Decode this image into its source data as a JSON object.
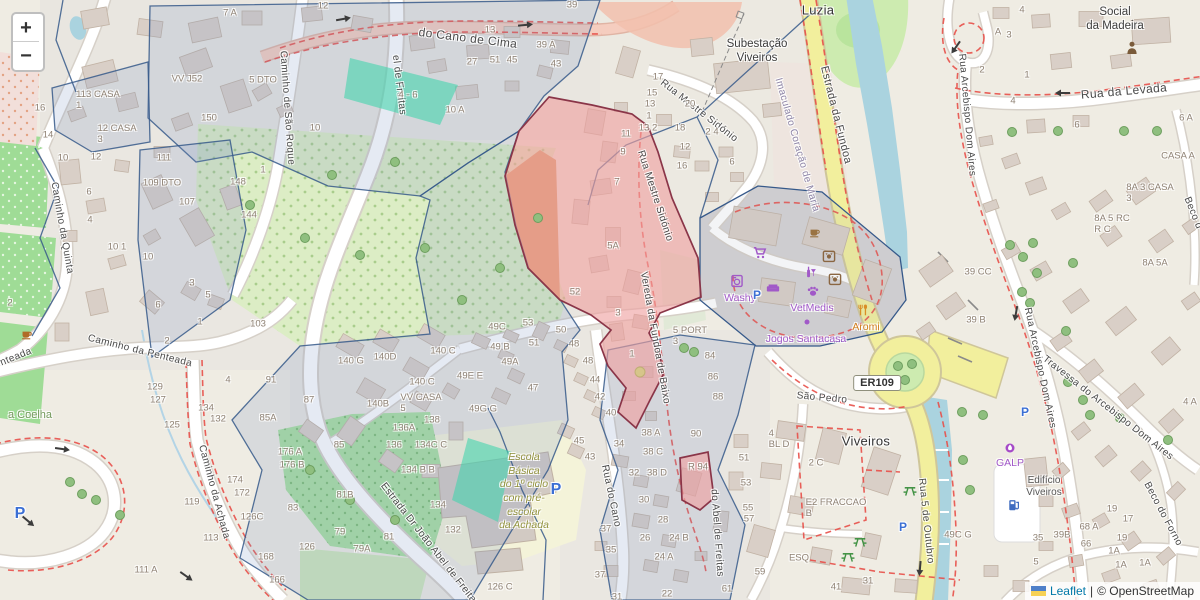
{
  "app": {
    "kind": "leaflet-openstreetmap-view"
  },
  "controls": {
    "zoom_in": "+",
    "zoom_out": "−"
  },
  "attribution": {
    "leaflet": "Leaflet",
    "sep": "|",
    "osm": "© OpenStreetMap"
  },
  "colors": {
    "water": "#aad3df",
    "road_yellow": "#f2ef9d",
    "overlay_red": "#ef9f9f",
    "overlay_red_border": "#8a3548",
    "overlay_teal": "#45d4ad",
    "admin_tint": "#7c98c3",
    "admin_border": "#36598a",
    "poi_purple": "#a159c8",
    "poi_orange": "#d98e26",
    "poi_brown": "#8a6642",
    "route_red": "#e8504a",
    "green": "#cdebb0",
    "building": "#d9cfc7",
    "leaflet_link": "#0078a8"
  },
  "labels": [
    {
      "t": "el de Freitas",
      "x": 399,
      "y": 85,
      "r": 83,
      "c": "s",
      "n": "street-label-abel-de-freitas-n"
    },
    {
      "t": "Caminho de São Roque",
      "x": 287,
      "y": 108,
      "r": 86,
      "c": "s"
    },
    {
      "t": "do Cano de Cima",
      "x": 468,
      "y": 38,
      "r": 7,
      "c": "s",
      "fs": 12
    },
    {
      "t": "Caminho da Quinta",
      "x": 62,
      "y": 228,
      "r": 80,
      "c": "s"
    },
    {
      "t": "nteada",
      "x": 16,
      "y": 357,
      "r": -22,
      "c": "s"
    },
    {
      "t": "Caminho da Penteada",
      "x": 140,
      "y": 351,
      "r": 14,
      "c": "s"
    },
    {
      "t": "Caminho da Achada",
      "x": 214,
      "y": 492,
      "r": 75,
      "c": "s"
    },
    {
      "t": "Estrada Dr João Abel de Freitas",
      "x": 430,
      "y": 545,
      "r": 52,
      "c": "s"
    },
    {
      "t": "do Abel de Freitas",
      "x": 717,
      "y": 533,
      "r": 86,
      "c": "s"
    },
    {
      "t": "Rua do Cano",
      "x": 611,
      "y": 496,
      "r": 78,
      "c": "s"
    },
    {
      "t": "Rua Mestre Sidónio",
      "x": 699,
      "y": 111,
      "r": 38,
      "c": "s"
    },
    {
      "t": "Rua Mestre Sidónio",
      "x": 655,
      "y": 196,
      "r": 72,
      "c": "s"
    },
    {
      "t": "Vereda da Fundoa de Baixo",
      "x": 655,
      "y": 338,
      "r": 80,
      "c": "s"
    },
    {
      "t": "Estrada da Fundoa",
      "x": 836,
      "y": 115,
      "r": 76,
      "c": "s",
      "fs": 11
    },
    {
      "t": "Imaculado Coração de Maria",
      "x": 797,
      "y": 145,
      "r": 74,
      "c": "sv"
    },
    {
      "t": "Rua da Levada",
      "x": 1124,
      "y": 91,
      "r": -5,
      "c": "s",
      "fs": 12
    },
    {
      "t": "Rua Arcebispo Dom Aires",
      "x": 967,
      "y": 115,
      "r": 85,
      "c": "s"
    },
    {
      "t": "Rua Arcebispo Dom Aires",
      "x": 1040,
      "y": 368,
      "r": 78,
      "c": "s"
    },
    {
      "t": "Travessa do Arcebispo Dom Aires",
      "x": 1108,
      "y": 408,
      "r": 38,
      "c": "s"
    },
    {
      "t": "Beco do Forno",
      "x": 1163,
      "y": 514,
      "r": 62,
      "c": "s"
    },
    {
      "t": "Beco d",
      "x": 1193,
      "y": 213,
      "r": 68,
      "c": "s"
    },
    {
      "t": "Rua 5 de Outubro",
      "x": 926,
      "y": 521,
      "r": 84,
      "c": "s"
    },
    {
      "t": "São Pedro",
      "x": 822,
      "y": 398,
      "r": 5,
      "c": "s"
    },
    {
      "t": "Luzia",
      "x": 818,
      "y": 10,
      "c": "p",
      "n": "place-label-luzia"
    },
    {
      "t": "Subestação\nViveiros",
      "x": 757,
      "y": 52,
      "c": "pm",
      "n": "place-label-subestacao-viveiros"
    },
    {
      "t": "Social\nda Madeira",
      "x": 1115,
      "y": 20,
      "c": "pm",
      "n": "place-label-social-da-madeira"
    },
    {
      "t": "Viveiros",
      "x": 866,
      "y": 441,
      "c": "p",
      "n": "place-label-viveiros"
    },
    {
      "t": "a Coelha",
      "x": 30,
      "y": 415,
      "c": "g"
    },
    {
      "t": "Escola\nBásica\ndo 1º ciclo\ncom pré-\nescolar\nda Achada",
      "x": 524,
      "y": 492,
      "c": "sch",
      "n": "place-label-escola-basica"
    },
    {
      "t": "Edifício\nViveiros",
      "x": 1044,
      "y": 487,
      "c": "pm2"
    },
    {
      "t": "ER109",
      "x": 877,
      "y": 383,
      "c": "ref",
      "n": "road-ref-er109"
    },
    {
      "t": "Washy",
      "x": 740,
      "y": 298,
      "c": "pp",
      "n": "poi-label-washy"
    },
    {
      "t": "VetMedis",
      "x": 812,
      "y": 308,
      "c": "pp",
      "n": "poi-label-vetmedis"
    },
    {
      "t": "Jogos Santacasa",
      "x": 806,
      "y": 339,
      "c": "pp",
      "n": "poi-label-jogos-santacasa"
    },
    {
      "t": "Aromi",
      "x": 866,
      "y": 327,
      "c": "po",
      "n": "poi-label-aromi"
    },
    {
      "t": "GALP",
      "x": 1010,
      "y": 463,
      "c": "pp",
      "n": "poi-label-galp"
    },
    {
      "t": "P",
      "x": 757,
      "y": 295,
      "c": "pb",
      "n": "parking-p-icon"
    },
    {
      "t": "P",
      "x": 556,
      "y": 490,
      "c": "pbl",
      "n": "parking-p-icon"
    },
    {
      "t": "P",
      "x": 903,
      "y": 527,
      "c": "pb",
      "n": "parking-p-icon"
    },
    {
      "t": "P",
      "x": 1025,
      "y": 412,
      "c": "pb",
      "n": "parking-p-icon"
    },
    {
      "t": "P",
      "x": 20,
      "y": 514,
      "c": "pbl",
      "n": "parking-p-icon"
    },
    {
      "t": "7 A",
      "x": 230,
      "y": 13
    },
    {
      "t": "5 DTO",
      "x": 263,
      "y": 80
    },
    {
      "t": "VV J52",
      "x": 187,
      "y": 79
    },
    {
      "t": "150",
      "x": 209,
      "y": 118
    },
    {
      "t": "16",
      "x": 40,
      "y": 108
    },
    {
      "t": "14",
      "x": 48,
      "y": 135
    },
    {
      "t": "10",
      "x": 63,
      "y": 158
    },
    {
      "t": "12",
      "x": 96,
      "y": 157
    },
    {
      "t": "113 CASA\n1",
      "x": 98,
      "y": 100
    },
    {
      "t": "12 CASA\n3",
      "x": 117,
      "y": 134
    },
    {
      "t": "111",
      "x": 164,
      "y": 158
    },
    {
      "t": "109 DTO",
      "x": 162,
      "y": 183
    },
    {
      "t": "107",
      "x": 187,
      "y": 202
    },
    {
      "t": "148",
      "x": 238,
      "y": 182
    },
    {
      "t": "1",
      "x": 263,
      "y": 170
    },
    {
      "t": "144",
      "x": 249,
      "y": 215
    },
    {
      "t": "6",
      "x": 89,
      "y": 192
    },
    {
      "t": "4",
      "x": 90,
      "y": 220
    },
    {
      "t": "10 1",
      "x": 117,
      "y": 247
    },
    {
      "t": "10",
      "x": 148,
      "y": 257
    },
    {
      "t": "103",
      "x": 258,
      "y": 324
    },
    {
      "t": "3",
      "x": 192,
      "y": 283
    },
    {
      "t": "5",
      "x": 208,
      "y": 295
    },
    {
      "t": "6",
      "x": 158,
      "y": 305
    },
    {
      "t": "2",
      "x": 10,
      "y": 303
    },
    {
      "t": "1",
      "x": 200,
      "y": 322
    },
    {
      "t": "2",
      "x": 167,
      "y": 341
    },
    {
      "t": "4",
      "x": 228,
      "y": 380
    },
    {
      "t": "91",
      "x": 271,
      "y": 380
    },
    {
      "t": "87",
      "x": 309,
      "y": 400
    },
    {
      "t": "85A",
      "x": 268,
      "y": 418
    },
    {
      "t": "129",
      "x": 155,
      "y": 387
    },
    {
      "t": "127",
      "x": 158,
      "y": 400
    },
    {
      "t": "125",
      "x": 172,
      "y": 425
    },
    {
      "t": "134",
      "x": 206,
      "y": 408
    },
    {
      "t": "132",
      "x": 218,
      "y": 419
    },
    {
      "t": "176 A",
      "x": 290,
      "y": 452
    },
    {
      "t": "176 B",
      "x": 292,
      "y": 465
    },
    {
      "t": "174",
      "x": 235,
      "y": 480
    },
    {
      "t": "172",
      "x": 242,
      "y": 493
    },
    {
      "t": "126C",
      "x": 252,
      "y": 517
    },
    {
      "t": "83",
      "x": 293,
      "y": 508
    },
    {
      "t": "126",
      "x": 307,
      "y": 547
    },
    {
      "t": "168",
      "x": 266,
      "y": 557
    },
    {
      "t": "166",
      "x": 277,
      "y": 580
    },
    {
      "t": "119",
      "x": 192,
      "y": 502
    },
    {
      "t": "113",
      "x": 211,
      "y": 538
    },
    {
      "t": "111 A",
      "x": 146,
      "y": 570
    },
    {
      "t": "12",
      "x": 323,
      "y": 6
    },
    {
      "t": "13",
      "x": 490,
      "y": 30
    },
    {
      "t": "39",
      "x": 572,
      "y": 5
    },
    {
      "t": "39 A",
      "x": 546,
      "y": 45
    },
    {
      "t": "10",
      "x": 315,
      "y": 128
    },
    {
      "t": "4 - 6",
      "x": 408,
      "y": 95
    },
    {
      "t": "10 A",
      "x": 455,
      "y": 110
    },
    {
      "t": "27",
      "x": 472,
      "y": 62
    },
    {
      "t": "51",
      "x": 495,
      "y": 60
    },
    {
      "t": "45",
      "x": 512,
      "y": 60
    },
    {
      "t": "43",
      "x": 556,
      "y": 64
    },
    {
      "t": "17",
      "x": 658,
      "y": 77
    },
    {
      "t": "15",
      "x": 652,
      "y": 93
    },
    {
      "t": "13",
      "x": 650,
      "y": 104
    },
    {
      "t": "1",
      "x": 649,
      "y": 116
    },
    {
      "t": "13 2",
      "x": 648,
      "y": 128
    },
    {
      "t": "11",
      "x": 626,
      "y": 134
    },
    {
      "t": "9",
      "x": 623,
      "y": 152
    },
    {
      "t": "7",
      "x": 617,
      "y": 182
    },
    {
      "t": "20",
      "x": 690,
      "y": 104
    },
    {
      "t": "18",
      "x": 680,
      "y": 128
    },
    {
      "t": "2 4",
      "x": 712,
      "y": 132
    },
    {
      "t": "12",
      "x": 685,
      "y": 147
    },
    {
      "t": "16",
      "x": 682,
      "y": 166
    },
    {
      "t": "6",
      "x": 732,
      "y": 162
    },
    {
      "t": "5A",
      "x": 613,
      "y": 246
    },
    {
      "t": "52",
      "x": 575,
      "y": 292
    },
    {
      "t": "3",
      "x": 618,
      "y": 313
    },
    {
      "t": "1",
      "x": 632,
      "y": 354
    },
    {
      "t": "49C",
      "x": 497,
      "y": 327
    },
    {
      "t": "53",
      "x": 528,
      "y": 323
    },
    {
      "t": "49 B",
      "x": 500,
      "y": 347
    },
    {
      "t": "51",
      "x": 534,
      "y": 343
    },
    {
      "t": "49A",
      "x": 510,
      "y": 362
    },
    {
      "t": "49E E",
      "x": 470,
      "y": 376
    },
    {
      "t": "47",
      "x": 533,
      "y": 388
    },
    {
      "t": "49G G",
      "x": 483,
      "y": 409
    },
    {
      "t": "50",
      "x": 561,
      "y": 330
    },
    {
      "t": "48",
      "x": 574,
      "y": 344
    },
    {
      "t": "48",
      "x": 588,
      "y": 361
    },
    {
      "t": "44",
      "x": 595,
      "y": 380
    },
    {
      "t": "42",
      "x": 600,
      "y": 397
    },
    {
      "t": "40",
      "x": 611,
      "y": 413
    },
    {
      "t": "45",
      "x": 579,
      "y": 441
    },
    {
      "t": "43",
      "x": 590,
      "y": 457
    },
    {
      "t": "140 G",
      "x": 351,
      "y": 361
    },
    {
      "t": "140D",
      "x": 385,
      "y": 357
    },
    {
      "t": "140 C",
      "x": 443,
      "y": 351
    },
    {
      "t": "140 C",
      "x": 422,
      "y": 382
    },
    {
      "t": "140B",
      "x": 378,
      "y": 404
    },
    {
      "t": "VV CASA\n5",
      "x": 421,
      "y": 403
    },
    {
      "t": "136A",
      "x": 404,
      "y": 428
    },
    {
      "t": "138",
      "x": 432,
      "y": 420
    },
    {
      "t": "136",
      "x": 394,
      "y": 445
    },
    {
      "t": "134C C",
      "x": 431,
      "y": 445
    },
    {
      "t": "134 B B",
      "x": 418,
      "y": 470
    },
    {
      "t": "85",
      "x": 339,
      "y": 445
    },
    {
      "t": "134",
      "x": 438,
      "y": 505
    },
    {
      "t": "132",
      "x": 453,
      "y": 530
    },
    {
      "t": "126 C",
      "x": 500,
      "y": 587
    },
    {
      "t": "81B",
      "x": 345,
      "y": 495
    },
    {
      "t": "79",
      "x": 340,
      "y": 532
    },
    {
      "t": "81",
      "x": 389,
      "y": 537
    },
    {
      "t": "79A",
      "x": 362,
      "y": 549
    },
    {
      "t": "34",
      "x": 619,
      "y": 444
    },
    {
      "t": "38 A",
      "x": 651,
      "y": 433
    },
    {
      "t": "38 C",
      "x": 653,
      "y": 452
    },
    {
      "t": "32",
      "x": 634,
      "y": 473
    },
    {
      "t": "38 D",
      "x": 657,
      "y": 473
    },
    {
      "t": "30",
      "x": 644,
      "y": 500
    },
    {
      "t": "28",
      "x": 663,
      "y": 520
    },
    {
      "t": "26",
      "x": 645,
      "y": 538
    },
    {
      "t": "24 B",
      "x": 679,
      "y": 538
    },
    {
      "t": "24 A",
      "x": 664,
      "y": 557
    },
    {
      "t": "22",
      "x": 667,
      "y": 594
    },
    {
      "t": "37",
      "x": 606,
      "y": 529
    },
    {
      "t": "35",
      "x": 611,
      "y": 550
    },
    {
      "t": "37",
      "x": 600,
      "y": 575
    },
    {
      "t": "31",
      "x": 617,
      "y": 597
    },
    {
      "t": "90",
      "x": 696,
      "y": 434
    },
    {
      "t": "R 94",
      "x": 698,
      "y": 467
    },
    {
      "t": "51",
      "x": 744,
      "y": 458
    },
    {
      "t": "53",
      "x": 746,
      "y": 483
    },
    {
      "t": "55",
      "x": 748,
      "y": 508
    },
    {
      "t": "57",
      "x": 749,
      "y": 519
    },
    {
      "t": "59",
      "x": 760,
      "y": 572
    },
    {
      "t": "61",
      "x": 727,
      "y": 589
    },
    {
      "t": "41",
      "x": 836,
      "y": 587
    },
    {
      "t": "31",
      "x": 868,
      "y": 581
    },
    {
      "t": "84",
      "x": 710,
      "y": 356
    },
    {
      "t": "86",
      "x": 713,
      "y": 377
    },
    {
      "t": "88",
      "x": 718,
      "y": 397
    },
    {
      "t": "5 PORT\n3",
      "x": 690,
      "y": 336
    },
    {
      "t": "4\nBL D",
      "x": 779,
      "y": 439
    },
    {
      "t": "2 C",
      "x": 816,
      "y": 463
    },
    {
      "t": "E2 FRACCAO\nB",
      "x": 836,
      "y": 508
    },
    {
      "t": "ESQ",
      "x": 799,
      "y": 558
    },
    {
      "t": "39 CC",
      "x": 978,
      "y": 272
    },
    {
      "t": "39 B",
      "x": 976,
      "y": 320
    },
    {
      "t": "19",
      "x": 1112,
      "y": 509
    },
    {
      "t": "17",
      "x": 1128,
      "y": 519
    },
    {
      "t": "19",
      "x": 1122,
      "y": 538
    },
    {
      "t": "1A",
      "x": 1114,
      "y": 551
    },
    {
      "t": "1A",
      "x": 1121,
      "y": 565
    },
    {
      "t": "1A",
      "x": 1145,
      "y": 563
    },
    {
      "t": "68 A",
      "x": 1089,
      "y": 527
    },
    {
      "t": "66",
      "x": 1086,
      "y": 544
    },
    {
      "t": "35",
      "x": 1038,
      "y": 538
    },
    {
      "t": "39B",
      "x": 1062,
      "y": 535
    },
    {
      "t": "5",
      "x": 1036,
      "y": 562
    },
    {
      "t": "49C G",
      "x": 958,
      "y": 535
    },
    {
      "t": "4",
      "x": 1022,
      "y": 10
    },
    {
      "t": "3",
      "x": 1009,
      "y": 35
    },
    {
      "t": "A",
      "x": 998,
      "y": 32
    },
    {
      "t": "2",
      "x": 982,
      "y": 70
    },
    {
      "t": "1",
      "x": 1027,
      "y": 75
    },
    {
      "t": "4",
      "x": 1013,
      "y": 101
    },
    {
      "t": "6",
      "x": 1077,
      "y": 125
    },
    {
      "t": "6 A",
      "x": 1186,
      "y": 118
    },
    {
      "t": "4 A",
      "x": 1190,
      "y": 402
    },
    {
      "t": "CASA A",
      "x": 1178,
      "y": 156
    },
    {
      "t": "8A 3 CASA\n3",
      "x": 1150,
      "y": 193
    },
    {
      "t": "8A 5 RC\nR C",
      "x": 1112,
      "y": 224
    },
    {
      "t": "8A 5A",
      "x": 1155,
      "y": 263
    }
  ],
  "icons": [
    {
      "sym": "cart",
      "x": 760,
      "y": 253,
      "w": 14,
      "col": "#a159c8",
      "n": "shop-cart-icon"
    },
    {
      "sym": "washer",
      "x": 737,
      "y": 281,
      "w": 14,
      "col": "#a159c8",
      "n": "laundry-icon"
    },
    {
      "sym": "sofa",
      "x": 773,
      "y": 288,
      "w": 14,
      "col": "#a159c8",
      "n": "furniture-icon"
    },
    {
      "sym": "bottle",
      "x": 810,
      "y": 272,
      "w": 13,
      "col": "#a159c8",
      "n": "bar-icon"
    },
    {
      "sym": "paw",
      "x": 813,
      "y": 291,
      "w": 13,
      "col": "#a159c8",
      "n": "vet-paw-icon"
    },
    {
      "sym": "dot",
      "x": 807,
      "y": 322,
      "w": 8,
      "col": "#a159c8",
      "n": "poi-dot-icon"
    },
    {
      "sym": "cup",
      "x": 815,
      "y": 232,
      "w": 13,
      "col": "#9a7342",
      "n": "cafe-icon"
    },
    {
      "sym": "dog",
      "x": 829,
      "y": 256,
      "w": 14,
      "col": "#8a6642",
      "n": "pet-shop-icon"
    },
    {
      "sym": "dog",
      "x": 835,
      "y": 279,
      "w": 14,
      "col": "#8a6642",
      "n": "pet-shop-icon"
    },
    {
      "sym": "restaurant",
      "x": 863,
      "y": 310,
      "w": 13,
      "col": "#d98e26",
      "n": "restaurant-icon"
    },
    {
      "sym": "person",
      "x": 1132,
      "y": 48,
      "w": 16,
      "col": "#7a5b3a",
      "n": "community-centre-icon"
    },
    {
      "sym": "cup",
      "x": 27,
      "y": 334,
      "w": 13,
      "col": "#b06c28",
      "n": "cafe-icon"
    },
    {
      "sym": "picnic",
      "x": 910,
      "y": 490,
      "w": 14,
      "col": "#3f9142",
      "n": "picnic-table-icon"
    },
    {
      "sym": "picnic",
      "x": 860,
      "y": 541,
      "w": 14,
      "col": "#3f9142",
      "n": "picnic-table-icon"
    },
    {
      "sym": "picnic",
      "x": 848,
      "y": 556,
      "w": 14,
      "col": "#3f9142",
      "n": "picnic-table-icon"
    },
    {
      "sym": "fuel",
      "x": 1014,
      "y": 505,
      "w": 14,
      "col": "#3f6cc0",
      "n": "fuel-pump-icon"
    },
    {
      "sym": "galp",
      "x": 1010,
      "y": 448,
      "w": 12,
      "col": "#a64ac8",
      "n": "galp-brand-icon"
    }
  ]
}
